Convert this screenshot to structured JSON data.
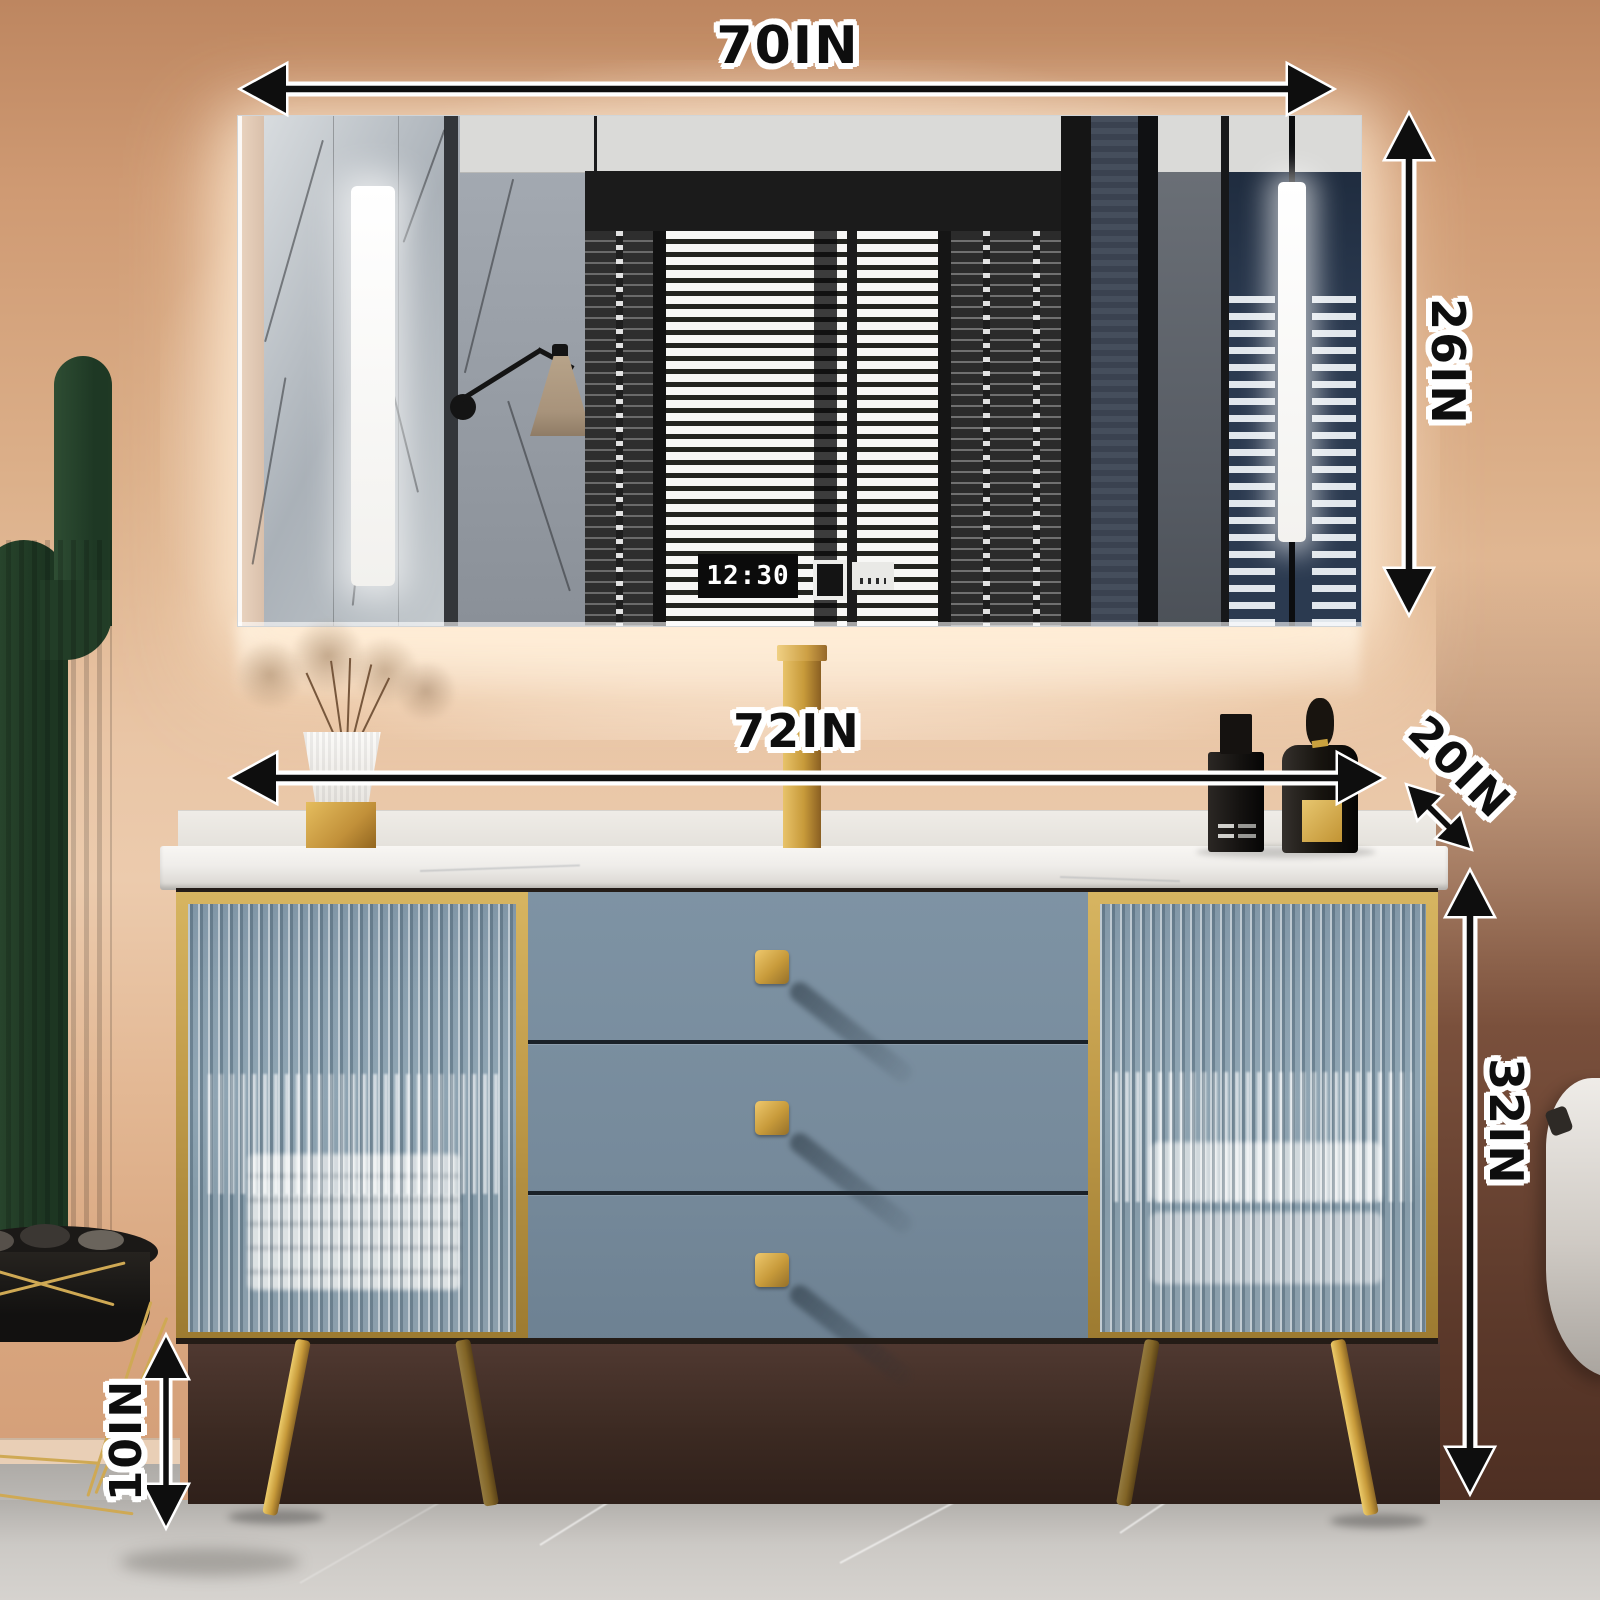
{
  "annotations": {
    "mirror_width": {
      "label": "70IN"
    },
    "mirror_height": {
      "label": "26IN"
    },
    "vanity_width": {
      "label": "72IN"
    },
    "vanity_depth": {
      "label": "20IN"
    },
    "vanity_height": {
      "label": "32IN"
    },
    "leg_height": {
      "label": "10IN"
    }
  },
  "mirror": {
    "clock_time": "12:30"
  },
  "colors": {
    "wall": "#d9a87f",
    "glow": "#f6e3cc",
    "accent_gold": "#c9a24a",
    "cabinet_blue": "#7b90a1",
    "marble_white": "#f4f2ee",
    "floor_gray": "#c6c3bf",
    "annotation_ink": "#0e0e0e",
    "annotation_outline": "#ffffff",
    "mirror_blue_wall": "#2b3a50",
    "cactus_green": "#24402a",
    "shadow_brown": "#3c2a22"
  }
}
